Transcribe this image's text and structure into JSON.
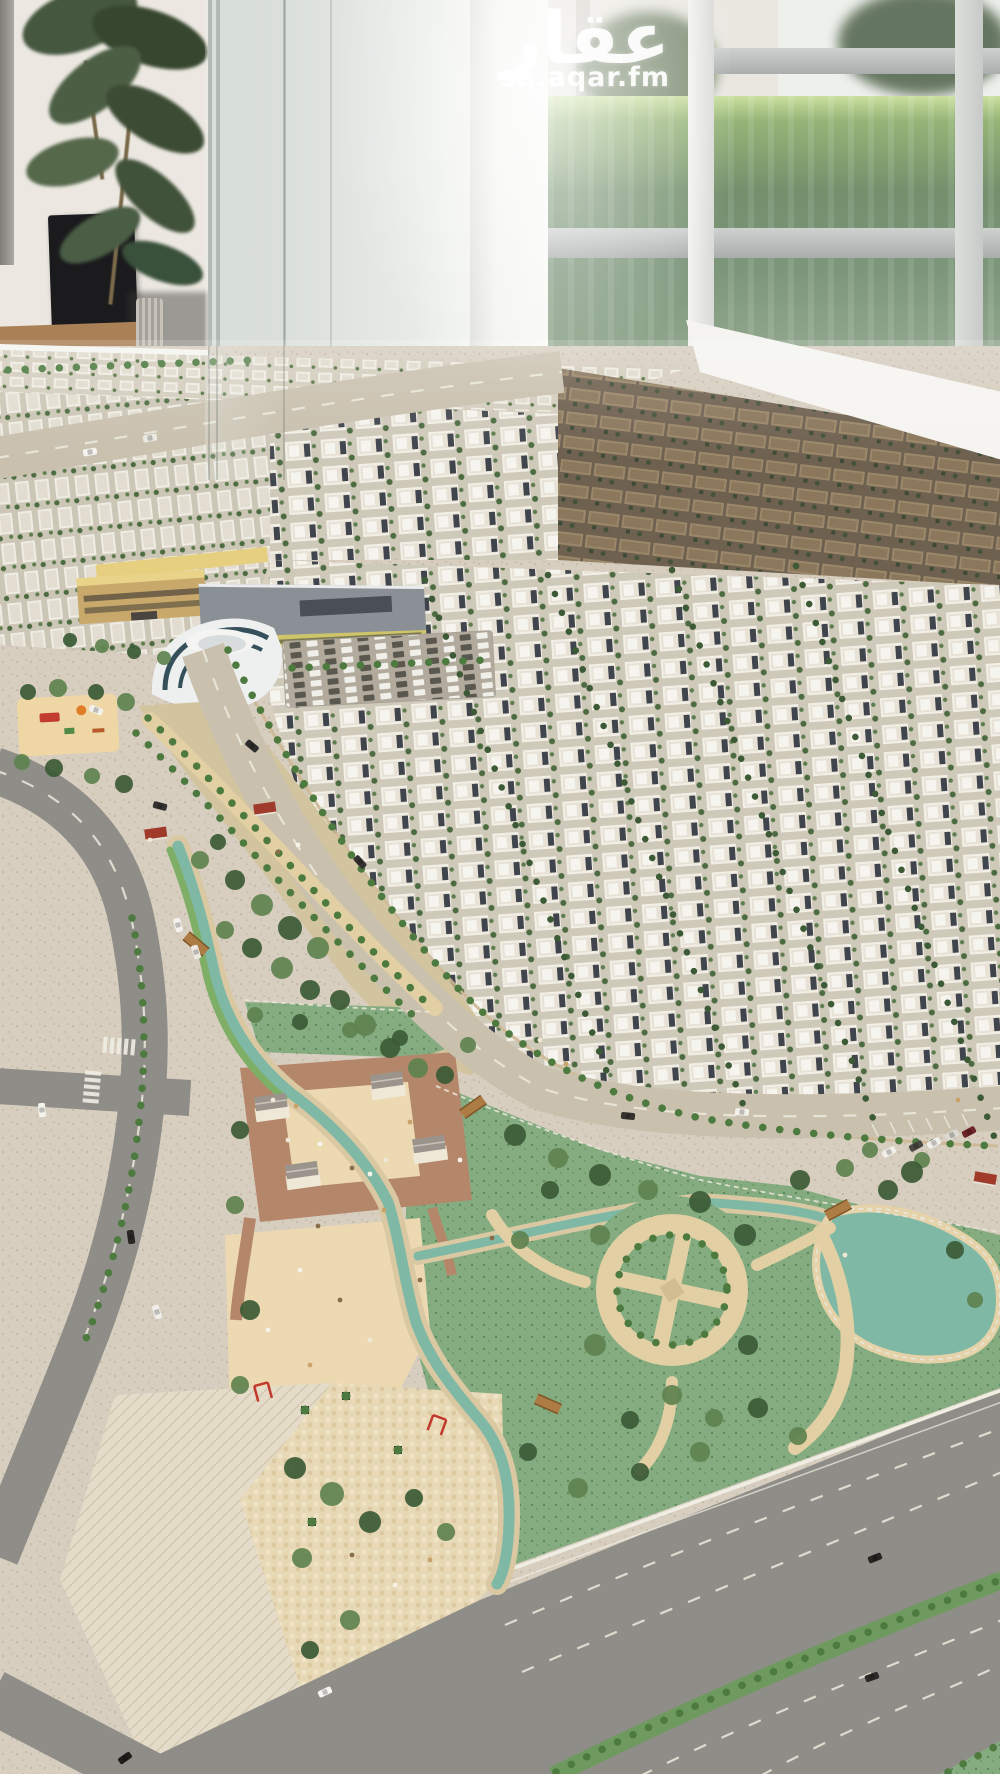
{
  "watermark": {
    "title": "عقار",
    "domain": "sa.aqar.fm"
  },
  "palette": {
    "asphalt": "#8f8d87",
    "asphaltLight": "#c9c0ae",
    "sand": "#d7cec0",
    "plaza": "#ecd9b2",
    "terracotta": "#b5876a",
    "pebble": "#e2cfa4",
    "lagoon": "#7fb8a4",
    "track": "#7fae66",
    "lawn": "#84ac80",
    "lawnDark": "#5d8a5d",
    "villa": "#f2efe7",
    "accent": "#40454d",
    "brown": "#9b8769",
    "palm": "#4c7a3f",
    "treeDark": "#3b5a35",
    "treeMid": "#5e824f",
    "treeOlive": "#74863f",
    "kioskRoof": "#9a948c",
    "pergolaRed": "#a03b2b",
    "wood": "#ad7b44",
    "schoolTan": "#c9a96b",
    "schoolRoof": "#8b9096",
    "schoolYellow": "#cdc46c",
    "curvedGlass": "#35505a",
    "white": "#f5f4f0",
    "laneDash": "#eceadd",
    "hedge": "#75907b"
  },
  "model": {
    "trees": [
      {
        "x": 28,
        "y": 692,
        "r": 8,
        "t": "d"
      },
      {
        "x": 58,
        "y": 688,
        "r": 9,
        "t": "m"
      },
      {
        "x": 96,
        "y": 692,
        "r": 8,
        "t": "d"
      },
      {
        "x": 126,
        "y": 702,
        "r": 9,
        "t": "m"
      },
      {
        "x": 22,
        "y": 762,
        "r": 8,
        "t": "m"
      },
      {
        "x": 54,
        "y": 768,
        "r": 9,
        "t": "d"
      },
      {
        "x": 92,
        "y": 776,
        "r": 8,
        "t": "m"
      },
      {
        "x": 124,
        "y": 784,
        "r": 9,
        "t": "d"
      },
      {
        "x": 70,
        "y": 640,
        "r": 7,
        "t": "d"
      },
      {
        "x": 102,
        "y": 646,
        "r": 7,
        "t": "m"
      },
      {
        "x": 134,
        "y": 652,
        "r": 7,
        "t": "d"
      },
      {
        "x": 164,
        "y": 658,
        "r": 7,
        "t": "m"
      },
      {
        "x": 235,
        "y": 880,
        "r": 10,
        "t": "d"
      },
      {
        "x": 262,
        "y": 905,
        "r": 11,
        "t": "m"
      },
      {
        "x": 290,
        "y": 928,
        "r": 12,
        "t": "d"
      },
      {
        "x": 318,
        "y": 948,
        "r": 11,
        "t": "m"
      },
      {
        "x": 252,
        "y": 948,
        "r": 10,
        "t": "d"
      },
      {
        "x": 282,
        "y": 968,
        "r": 11,
        "t": "m"
      },
      {
        "x": 310,
        "y": 990,
        "r": 10,
        "t": "d"
      },
      {
        "x": 225,
        "y": 930,
        "r": 9,
        "t": "m"
      },
      {
        "x": 340,
        "y": 1000,
        "r": 10,
        "t": "d"
      },
      {
        "x": 365,
        "y": 1025,
        "r": 11,
        "t": "m"
      },
      {
        "x": 390,
        "y": 1048,
        "r": 10,
        "t": "d"
      },
      {
        "x": 418,
        "y": 1068,
        "r": 10,
        "t": "m"
      },
      {
        "x": 200,
        "y": 860,
        "r": 9,
        "t": "m"
      },
      {
        "x": 218,
        "y": 842,
        "r": 8,
        "t": "d"
      },
      {
        "x": 255,
        "y": 1015,
        "r": 8,
        "t": "m"
      },
      {
        "x": 300,
        "y": 1022,
        "r": 8,
        "t": "d"
      },
      {
        "x": 350,
        "y": 1030,
        "r": 8,
        "t": "m"
      },
      {
        "x": 400,
        "y": 1038,
        "r": 8,
        "t": "d"
      },
      {
        "x": 240,
        "y": 1130,
        "r": 9,
        "t": "d"
      },
      {
        "x": 235,
        "y": 1205,
        "r": 9,
        "t": "m"
      },
      {
        "x": 250,
        "y": 1310,
        "r": 10,
        "t": "d"
      },
      {
        "x": 240,
        "y": 1385,
        "r": 9,
        "t": "m"
      },
      {
        "x": 445,
        "y": 1075,
        "r": 9,
        "t": "d"
      },
      {
        "x": 468,
        "y": 1045,
        "r": 8,
        "t": "m"
      },
      {
        "x": 515,
        "y": 1135,
        "r": 11,
        "t": "d"
      },
      {
        "x": 558,
        "y": 1158,
        "r": 10,
        "t": "m"
      },
      {
        "x": 600,
        "y": 1175,
        "r": 11,
        "t": "d"
      },
      {
        "x": 648,
        "y": 1190,
        "r": 10,
        "t": "m"
      },
      {
        "x": 700,
        "y": 1202,
        "r": 11,
        "t": "d"
      },
      {
        "x": 600,
        "y": 1235,
        "r": 10,
        "t": "m"
      },
      {
        "x": 745,
        "y": 1235,
        "r": 11,
        "t": "d"
      },
      {
        "x": 595,
        "y": 1345,
        "r": 11,
        "t": "m"
      },
      {
        "x": 748,
        "y": 1345,
        "r": 10,
        "t": "d"
      },
      {
        "x": 672,
        "y": 1395,
        "r": 10,
        "t": "m"
      },
      {
        "x": 630,
        "y": 1420,
        "r": 9,
        "t": "d"
      },
      {
        "x": 714,
        "y": 1418,
        "r": 9,
        "t": "m"
      },
      {
        "x": 550,
        "y": 1190,
        "r": 9,
        "t": "d"
      },
      {
        "x": 520,
        "y": 1240,
        "r": 9,
        "t": "m"
      },
      {
        "x": 800,
        "y": 1180,
        "r": 10,
        "t": "d"
      },
      {
        "x": 845,
        "y": 1168,
        "r": 9,
        "t": "m"
      },
      {
        "x": 888,
        "y": 1190,
        "r": 10,
        "t": "d"
      },
      {
        "x": 922,
        "y": 1160,
        "r": 8,
        "t": "m"
      },
      {
        "x": 955,
        "y": 1250,
        "r": 9,
        "t": "d"
      },
      {
        "x": 975,
        "y": 1300,
        "r": 8,
        "t": "m"
      },
      {
        "x": 912,
        "y": 1172,
        "r": 11,
        "t": "d"
      },
      {
        "x": 870,
        "y": 1150,
        "r": 8,
        "t": "m"
      },
      {
        "x": 758,
        "y": 1408,
        "r": 10,
        "t": "d"
      },
      {
        "x": 798,
        "y": 1436,
        "r": 9,
        "t": "m"
      },
      {
        "x": 700,
        "y": 1452,
        "r": 10,
        "t": "m"
      },
      {
        "x": 640,
        "y": 1472,
        "r": 9,
        "t": "d"
      },
      {
        "x": 578,
        "y": 1488,
        "r": 10,
        "t": "m"
      },
      {
        "x": 528,
        "y": 1452,
        "r": 9,
        "t": "d"
      },
      {
        "x": 295,
        "y": 1468,
        "r": 11,
        "t": "d"
      },
      {
        "x": 332,
        "y": 1494,
        "r": 12,
        "t": "m"
      },
      {
        "x": 370,
        "y": 1522,
        "r": 11,
        "t": "d"
      },
      {
        "x": 302,
        "y": 1558,
        "r": 10,
        "t": "m"
      },
      {
        "x": 414,
        "y": 1498,
        "r": 9,
        "t": "d"
      },
      {
        "x": 446,
        "y": 1532,
        "r": 9,
        "t": "m"
      },
      {
        "x": 350,
        "y": 1620,
        "r": 10,
        "t": "m"
      },
      {
        "x": 310,
        "y": 1650,
        "r": 9,
        "t": "d"
      }
    ],
    "cars": [
      {
        "x": 90,
        "y": 452,
        "a": -10,
        "c": "#f4f3ee"
      },
      {
        "x": 150,
        "y": 438,
        "a": -10,
        "c": "#e9e7e0"
      },
      {
        "x": 96,
        "y": 710,
        "a": 22,
        "c": "#f2f1ec"
      },
      {
        "x": 252,
        "y": 746,
        "a": 40,
        "c": "#2e2d2b"
      },
      {
        "x": 160,
        "y": 806,
        "a": 15,
        "c": "#343230"
      },
      {
        "x": 178,
        "y": 925,
        "a": 75,
        "c": "#f3f2ed"
      },
      {
        "x": 196,
        "y": 952,
        "a": 72,
        "c": "#eceae3"
      },
      {
        "x": 42,
        "y": 1110,
        "a": 85,
        "c": "#f4f3ee"
      },
      {
        "x": 131,
        "y": 1237,
        "a": 82,
        "c": "#2a2826"
      },
      {
        "x": 157,
        "y": 1312,
        "a": 72,
        "c": "#efeeea"
      },
      {
        "x": 628,
        "y": 1116,
        "a": 6,
        "c": "#35332f"
      },
      {
        "x": 742,
        "y": 1112,
        "a": 4,
        "c": "#f2f1eb"
      },
      {
        "x": 889,
        "y": 1152,
        "a": -28,
        "c": "#f1efe9"
      },
      {
        "x": 916,
        "y": 1146,
        "a": -28,
        "c": "#4a4843"
      },
      {
        "x": 934,
        "y": 1143,
        "a": -28,
        "c": "#f0efe9"
      },
      {
        "x": 952,
        "y": 1135,
        "a": -28,
        "c": "#dcd9d2"
      },
      {
        "x": 969,
        "y": 1132,
        "a": -28,
        "c": "#6e2328"
      },
      {
        "x": 325,
        "y": 1692,
        "a": -25,
        "c": "#f6f5f1"
      },
      {
        "x": 875,
        "y": 1558,
        "a": -22,
        "c": "#262522"
      },
      {
        "x": 872,
        "y": 1677,
        "a": -20,
        "c": "#2b2a27"
      },
      {
        "x": 125,
        "y": 1758,
        "a": -35,
        "c": "#1f1e1c"
      },
      {
        "x": 360,
        "y": 862,
        "a": 48,
        "c": "#343230"
      }
    ],
    "people": [
      {
        "x": 273,
        "y": 1100
      },
      {
        "x": 296,
        "y": 1106
      },
      {
        "x": 320,
        "y": 1144
      },
      {
        "x": 352,
        "y": 1168
      },
      {
        "x": 386,
        "y": 1160
      },
      {
        "x": 410,
        "y": 1122
      },
      {
        "x": 370,
        "y": 1174
      },
      {
        "x": 318,
        "y": 1226
      },
      {
        "x": 288,
        "y": 1140
      },
      {
        "x": 384,
        "y": 1210
      },
      {
        "x": 300,
        "y": 1270
      },
      {
        "x": 340,
        "y": 1300
      },
      {
        "x": 370,
        "y": 1340
      },
      {
        "x": 310,
        "y": 1365
      },
      {
        "x": 268,
        "y": 1330
      },
      {
        "x": 420,
        "y": 1280
      },
      {
        "x": 540,
        "y": 1040
      },
      {
        "x": 566,
        "y": 1064
      },
      {
        "x": 460,
        "y": 1160
      },
      {
        "x": 492,
        "y": 1238
      },
      {
        "x": 845,
        "y": 1255
      },
      {
        "x": 958,
        "y": 1100
      },
      {
        "x": 298,
        "y": 845
      },
      {
        "x": 278,
        "y": 852
      },
      {
        "x": 150,
        "y": 840
      },
      {
        "x": 430,
        "y": 1560
      },
      {
        "x": 395,
        "y": 1585
      },
      {
        "x": 352,
        "y": 1555
      }
    ],
    "kiosks": [
      {
        "x": 272,
        "y": 1110
      },
      {
        "x": 388,
        "y": 1088
      },
      {
        "x": 430,
        "y": 1152
      },
      {
        "x": 303,
        "y": 1178
      }
    ],
    "pergolas": [
      {
        "x": 156,
        "y": 835,
        "a": -8
      },
      {
        "x": 265,
        "y": 810,
        "a": -8
      },
      {
        "x": 985,
        "y": 1180,
        "a": 10
      }
    ],
    "bridges": [
      {
        "x": 473,
        "y": 1107,
        "a": -35
      },
      {
        "x": 838,
        "y": 1210,
        "a": -28
      },
      {
        "x": 548,
        "y": 1404,
        "a": 24
      },
      {
        "x": 196,
        "y": 944,
        "a": 40
      }
    ],
    "planters": [
      {
        "x": 305,
        "y": 1410
      },
      {
        "x": 346,
        "y": 1396
      },
      {
        "x": 398,
        "y": 1450
      },
      {
        "x": 312,
        "y": 1522
      }
    ],
    "redFrames": [
      {
        "x": 263,
        "y": 1392,
        "a": -15
      },
      {
        "x": 437,
        "y": 1425,
        "a": 20
      }
    ]
  }
}
